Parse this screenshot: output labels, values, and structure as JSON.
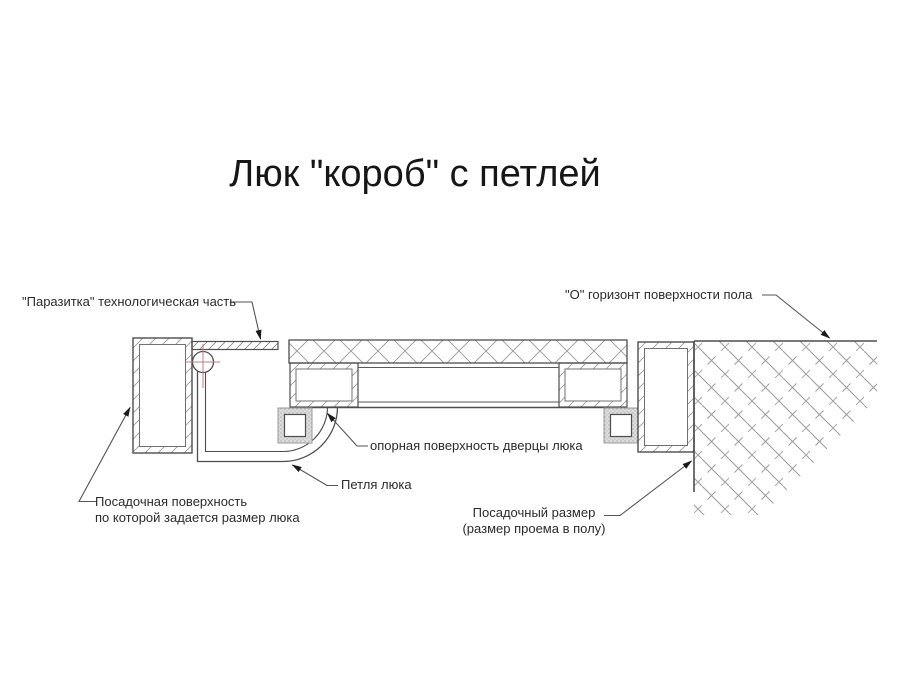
{
  "title": "Люк \"короб\" с петлей",
  "annotations": {
    "parasitka": "\"Паразитка\" технологическая часть",
    "floor_horizon": "\"О\" горизонт поверхности пола",
    "door_bearing_surface": "опорная поверхность дверцы люка",
    "hinge": "Петля люка",
    "seating_surface": {
      "line1": "Посадочная поверхность",
      "line2": "по которой задается размер люка"
    },
    "seating_size": {
      "line1": "Посадочный размер",
      "line2": "(размер проема в полу)"
    }
  },
  "colors": {
    "background": "#ffffff",
    "main_line": "#4d4d4d",
    "hatch_line": "#9a9a9a",
    "center_mark_red": "#c47e7e",
    "text": "#2b2b2b"
  }
}
